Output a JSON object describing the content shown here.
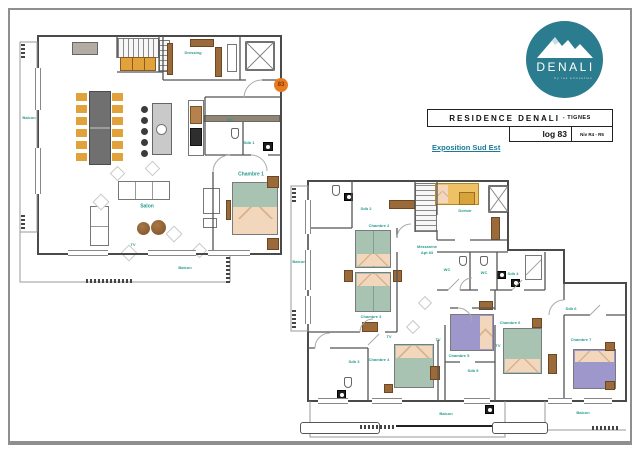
{
  "logo": {
    "name": "DENALI",
    "tagline": "by les etincelles",
    "circle_color": "#2b7c8e"
  },
  "title_block": {
    "residence": "RESIDENCE DENALI",
    "location": "- TIGNES",
    "lot": "log 83",
    "level": "Niv R4 - R5"
  },
  "exposition": "Exposition Sud Est",
  "plan_upper": {
    "door_badge": "83",
    "labels": {
      "balcon_left": "Balcon",
      "dressing": "Dressing",
      "wc": "WC",
      "sdb1": "Sdb 1",
      "chambre1": "Chambre 1",
      "salon": "Salon",
      "tv": "TV",
      "balcon_bottom": "Balcon"
    }
  },
  "plan_lower": {
    "labels": {
      "balcon_left": "Balcon",
      "sdb2": "Sdb 2",
      "chambre2": "Chambre 2",
      "chambre3": "Chambre 3",
      "mezzanine_line1": "Mezzanine",
      "mezzanine_line2": "Apt 83",
      "dortoir": "Dortoir",
      "wc_a": "WC",
      "wc_b": "WC",
      "sdb4": "Sdb 4",
      "sdb3": "Sdb 3",
      "chambre4": "Chambre 4",
      "tv_a": "TV",
      "tv_b": "TV",
      "chambre5": "Chambre 5",
      "sdb5": "Sdb 5",
      "chambre6": "Chambre 6",
      "tv_c": "TV",
      "sdb6": "Sdb 6",
      "chambre7": "Chambre 7",
      "balcon_bottom_a": "Balcon",
      "balcon_bottom_b": "Balcon"
    }
  },
  "colors": {
    "accent_teal": "#2b7c8e",
    "label_teal": "#279b8d",
    "exposition_blue": "#1b7a99",
    "badge_orange": "#e87b1f",
    "chair_orange": "#e2a23b",
    "wood_brown": "#9a6a3b",
    "bed_green": "#a9c3b2",
    "bed_purple": "#9e97cc",
    "pillow_peach": "#f2d7bd",
    "dortoir_bed": "#eec264",
    "table_gray": "#707070"
  }
}
